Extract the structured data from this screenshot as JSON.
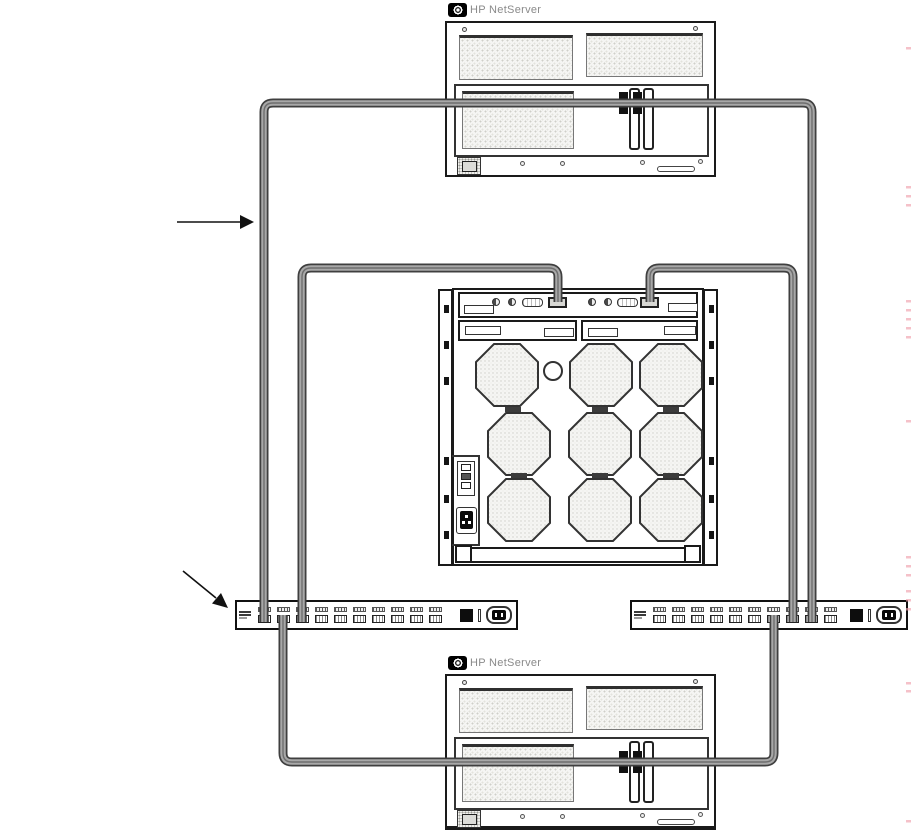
{
  "colors": {
    "background": "#ffffff",
    "line": "#1a1a1a",
    "stipple_fill": "#f5f5f3",
    "stipple_dot": "#cfcfc9",
    "cable_outline": "#3f3f3f",
    "cable_body": "#a8a8a8",
    "cable_core": "#6e6e6e",
    "logo_black": "#000000",
    "logo_text_gray": "#8a8a8a",
    "edge_artifact_pink": "#f0a0ac"
  },
  "servers": {
    "top": {
      "label": "HP NetServer"
    },
    "bottom": {
      "label": "HP NetServer"
    }
  },
  "disk_enclosure": {
    "fan_grid_rows": 3,
    "fan_grid_cols": 3,
    "top_port_count": 2,
    "led_pairs": 2
  },
  "hubs": {
    "port_count": 10,
    "left": {
      "position": "left"
    },
    "right": {
      "position": "right"
    }
  },
  "cables": [
    {
      "id": "top-server-loop",
      "route": "top server adapter cards to left hub and right hub"
    },
    {
      "id": "enclosure-left-port",
      "route": "enclosure left top port to left hub"
    },
    {
      "id": "enclosure-right-port",
      "route": "enclosure right top port to right hub"
    },
    {
      "id": "bottom-server-loop",
      "route": "left hub and right hub to bottom server adapter cards"
    }
  ],
  "annotations": {
    "arrow_count": 2
  }
}
